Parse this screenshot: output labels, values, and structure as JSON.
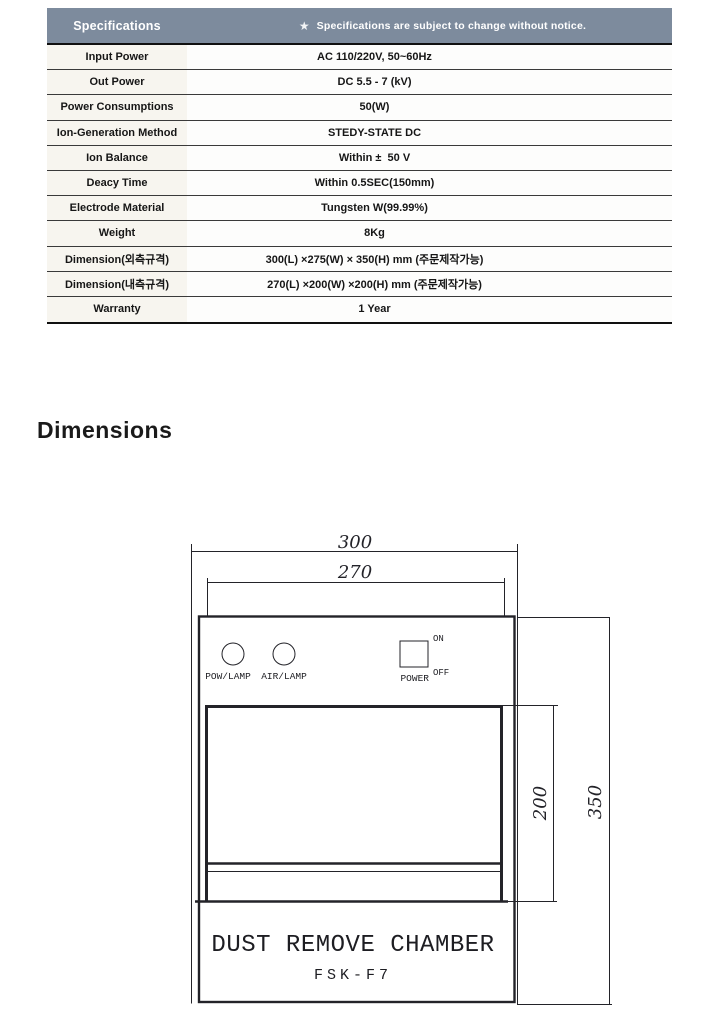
{
  "spec_table": {
    "header": {
      "title": "Specifications",
      "star": "★",
      "note": "Specifications are subject to change without notice.",
      "bg": "#7d8b9d",
      "label_bg": "#f7f5ef",
      "value_bg": "#fdfdfc"
    },
    "rows": [
      {
        "label": "Input Power",
        "value": "AC 110/220V, 50~60Hz"
      },
      {
        "label": "Out Power",
        "value": "DC 5.5 - 7 (kV)"
      },
      {
        "label": "Power Consumptions",
        "value": "50(W)"
      },
      {
        "label": "Ion-Generation Method",
        "value": "STEDY-STATE DC"
      },
      {
        "label": "Ion Balance",
        "value": "Within ±  50 V"
      },
      {
        "label": "Deacy Time",
        "value": "Within 0.5SEC(150mm)"
      },
      {
        "label": "Electrode Material",
        "value": "Tungsten W(99.99%)"
      },
      {
        "label": "Weight",
        "value": "8Kg"
      },
      {
        "label": "Dimension(외측규격)",
        "value": "300(L) ×275(W) × 350(H) mm (주문제작가능)"
      },
      {
        "label": "Dimension(내측규격)",
        "value": "270(L) ×200(W) ×200(H) mm (주문제작가능)"
      },
      {
        "label": "Warranty",
        "value": "1 Year"
      }
    ]
  },
  "section": {
    "title": "Dimensions"
  },
  "diagram": {
    "dims": {
      "outer_width": "300",
      "inner_width": "270",
      "inner_height": "200",
      "outer_height": "350"
    },
    "labels": {
      "pow_lamp": "POW/LAMP",
      "air_lamp": "AIR/LAMP",
      "power": "POWER",
      "on": "ON",
      "off": "OFF"
    },
    "product": {
      "name": "DUST REMOVE CHAMBER",
      "model": "FSK-F7"
    },
    "line_color": "#232329"
  }
}
